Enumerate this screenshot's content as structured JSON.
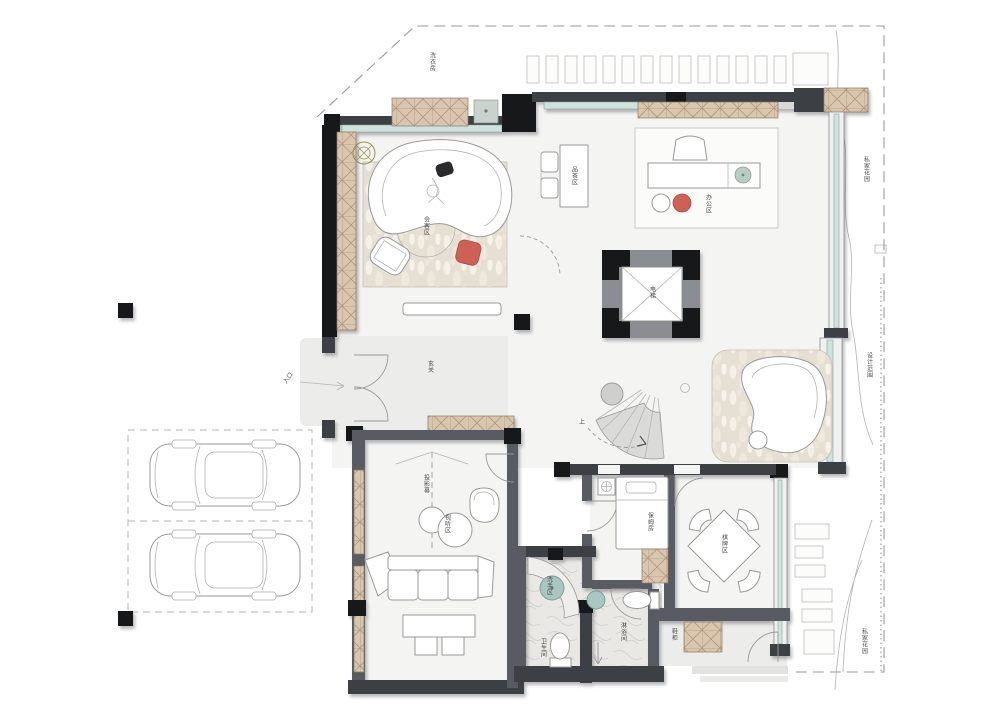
{
  "plan_type": "residential-first-floor-plan",
  "labels": {
    "laundry": "洗衣房",
    "reception": "会客区",
    "tea_area": "品茶区",
    "office_area": "办公区",
    "elevator": "电梯",
    "foyer": "玄关",
    "entrance": "入口",
    "stairs_up": "上",
    "projection": "投影幕",
    "av_area": "视听区",
    "nanny_room": "保姆房",
    "mahjong_area": "棋牌区",
    "wash_area": "洗手区",
    "wc": "卫生间",
    "shower_room": "淋浴间",
    "shoe_cabinet": "鞋柜",
    "garden_upper": "私家花园",
    "design_scope": "设计范围",
    "garden_lower": "私家花园"
  },
  "colors": {
    "wall_dark": "#3c3f44",
    "column_black": "#17181a",
    "cabinet_tan": "#d9c6af",
    "glazing_teal": "#cfe2dd",
    "accent_red": "#cd6156",
    "fixture_teal": "#a9c7c2",
    "rug_beige": "#e6dfd3"
  }
}
